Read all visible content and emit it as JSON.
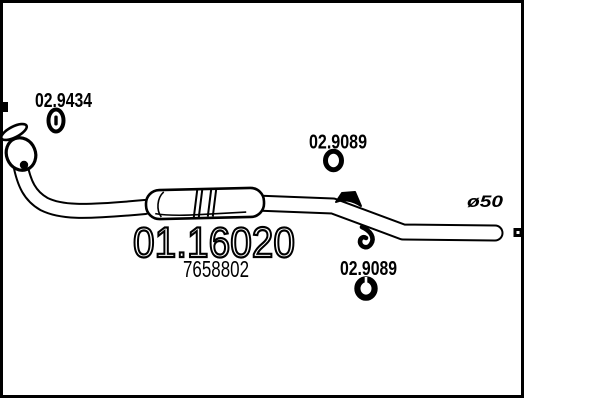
{
  "drawing": {
    "background_color": "#ffffff",
    "line_color": "#000000",
    "part_code": "01.16020",
    "oem_code": "7658802",
    "gasket_code": "02.9434",
    "hanger_code_top": "02.9089",
    "hanger_code_bottom": "02.9089",
    "pipe_diameter": "ø50"
  }
}
